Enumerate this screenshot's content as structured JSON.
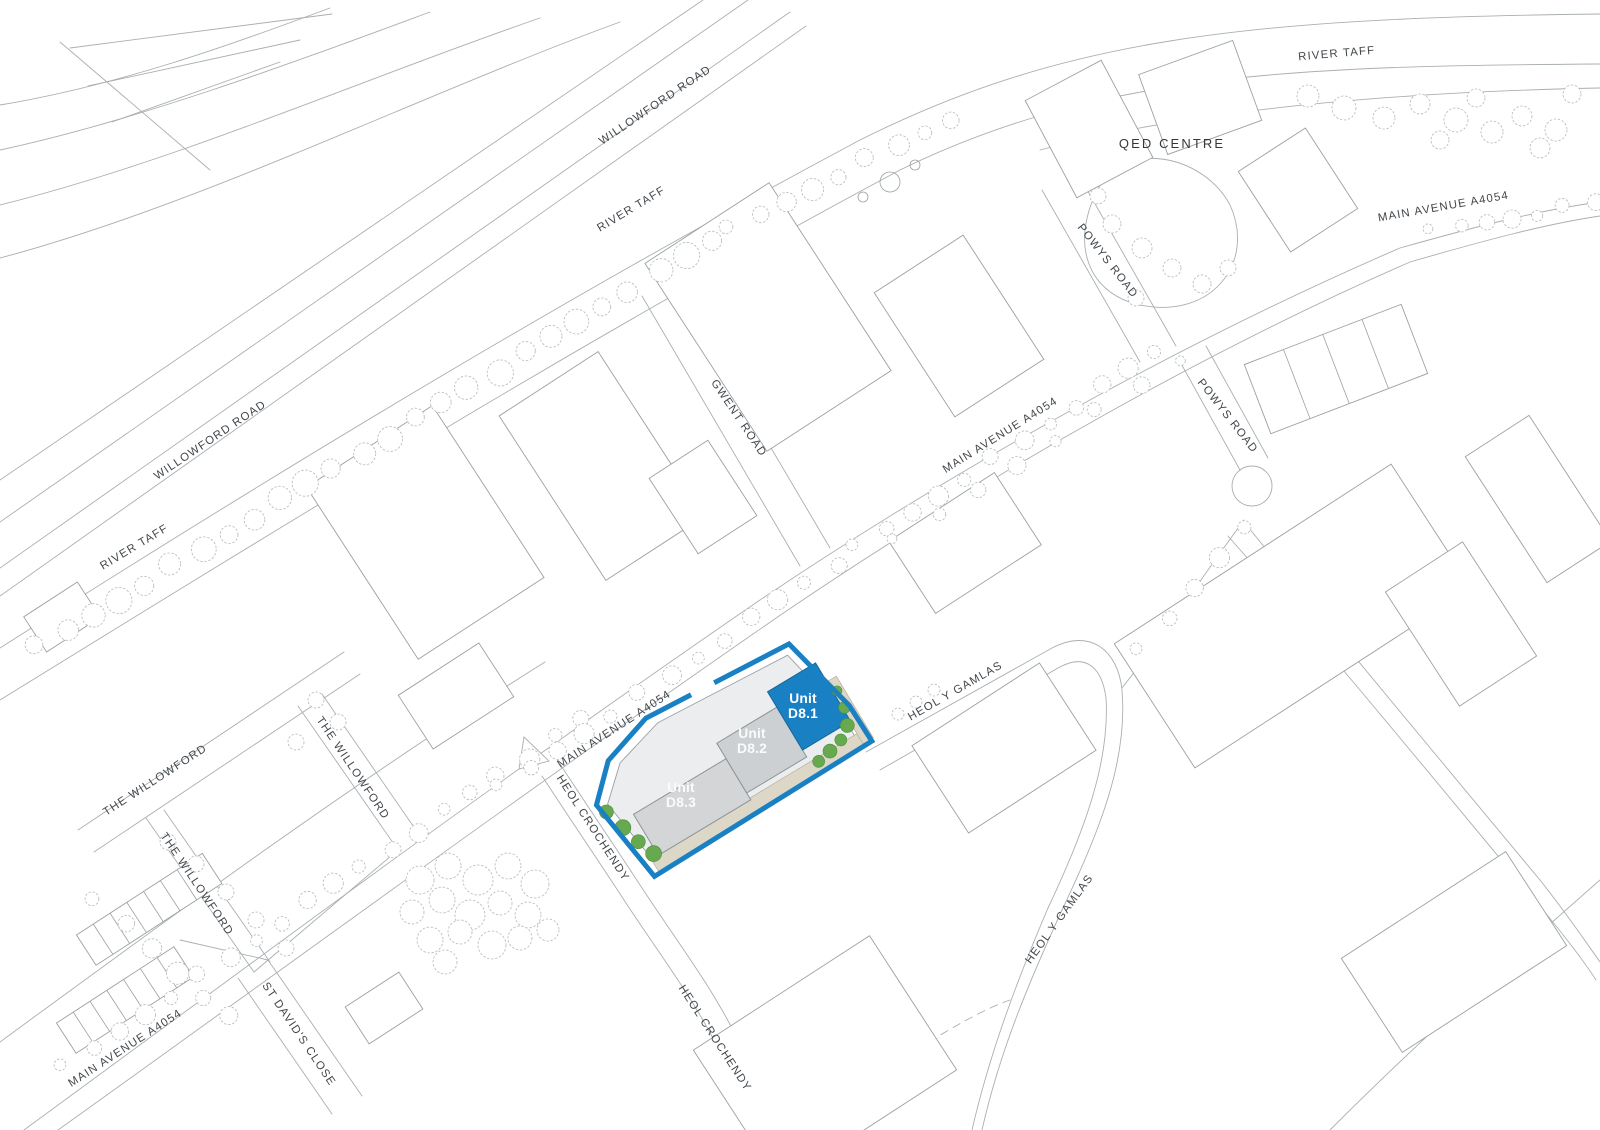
{
  "page": {
    "background": "#ffffff"
  },
  "colors": {
    "line_gray": "#a9afb2",
    "building_line": "#9aa1a4",
    "tree_line": "#b6bcbf",
    "label_gray": "#42474b",
    "site_blue": "#1a80c4",
    "site_blue_edge": "#156999",
    "unit_d82_gray": "#ccd0d2",
    "unit_d83_gray": "#d3d5d6",
    "parcel_fill": "#ebedee",
    "road_strip_beige": "#ddd7c8",
    "road_strip_edge": "#b9b09c",
    "landscape_green": "#67a94f",
    "landscape_green_edge": "#4f8f3c",
    "unit_label_white": "#ffffff",
    "unit_label_soft_white": "#fafbfb"
  },
  "site": {
    "name": "Unit D8 development site",
    "units": [
      {
        "id": "unit-d8-1",
        "line1": "Unit",
        "line2": "D8.1",
        "label_x": 803,
        "label_y": 703,
        "text_color": "#ffffff"
      },
      {
        "id": "unit-d8-2",
        "line1": "Unit",
        "line2": "D8.2",
        "label_x": 752,
        "label_y": 738,
        "text_color": "#fafbfb"
      },
      {
        "id": "unit-d8-3",
        "line1": "Unit",
        "line2": "D8.3",
        "label_x": 681,
        "label_y": 792,
        "text_color": "#fafbfb"
      }
    ]
  },
  "map_labels": [
    {
      "text": "WILLOWFORD ROAD",
      "x": 657,
      "y": 108,
      "rot": -34
    },
    {
      "text": "RIVER TAFF",
      "x": 633,
      "y": 212,
      "rot": -31
    },
    {
      "text": "RIVER TAFF",
      "x": 1337,
      "y": 57,
      "rot": -5
    },
    {
      "text": "QED CENTRE",
      "x": 1172,
      "y": 148,
      "rot": 0,
      "big": true
    },
    {
      "text": "MAIN AVENUE  A4054",
      "x": 1444,
      "y": 210,
      "rot": -10
    },
    {
      "text": "POWYS ROAD",
      "x": 1105,
      "y": 263,
      "rot": 52
    },
    {
      "text": "GWENT ROAD",
      "x": 736,
      "y": 420,
      "rot": 56
    },
    {
      "text": "MAIN AVENUE  A4054",
      "x": 1002,
      "y": 438,
      "rot": -32
    },
    {
      "text": "POWYS ROAD",
      "x": 1225,
      "y": 418,
      "rot": 52
    },
    {
      "text": "WILLOWFORD ROAD",
      "x": 212,
      "y": 443,
      "rot": -34
    },
    {
      "text": "RIVER TAFF",
      "x": 136,
      "y": 550,
      "rot": -31
    },
    {
      "text": "HEOL Y GAMLAS",
      "x": 957,
      "y": 694,
      "rot": -30
    },
    {
      "text": "MAIN AVENUE  A4054",
      "x": 616,
      "y": 732,
      "rot": -33
    },
    {
      "text": "THE WILLOWFORD",
      "x": 157,
      "y": 783,
      "rot": -33
    },
    {
      "text": "THE WILLOWFORD",
      "x": 350,
      "y": 770,
      "rot": 56
    },
    {
      "text": "HEOL CROCHENDY",
      "x": 590,
      "y": 830,
      "rot": 57
    },
    {
      "text": "THE WILLOWFORD",
      "x": 194,
      "y": 886,
      "rot": 56
    },
    {
      "text": "HEOL Y GAMLAS",
      "x": 1062,
      "y": 921,
      "rot": -54
    },
    {
      "text": "ST DAVID'S CLOSE",
      "x": 296,
      "y": 1036,
      "rot": 56
    },
    {
      "text": "MAIN AVENUE  A4054",
      "x": 127,
      "y": 1051,
      "rot": -33
    },
    {
      "text": "HEOL CROCHENDY",
      "x": 712,
      "y": 1040,
      "rot": 57
    }
  ]
}
